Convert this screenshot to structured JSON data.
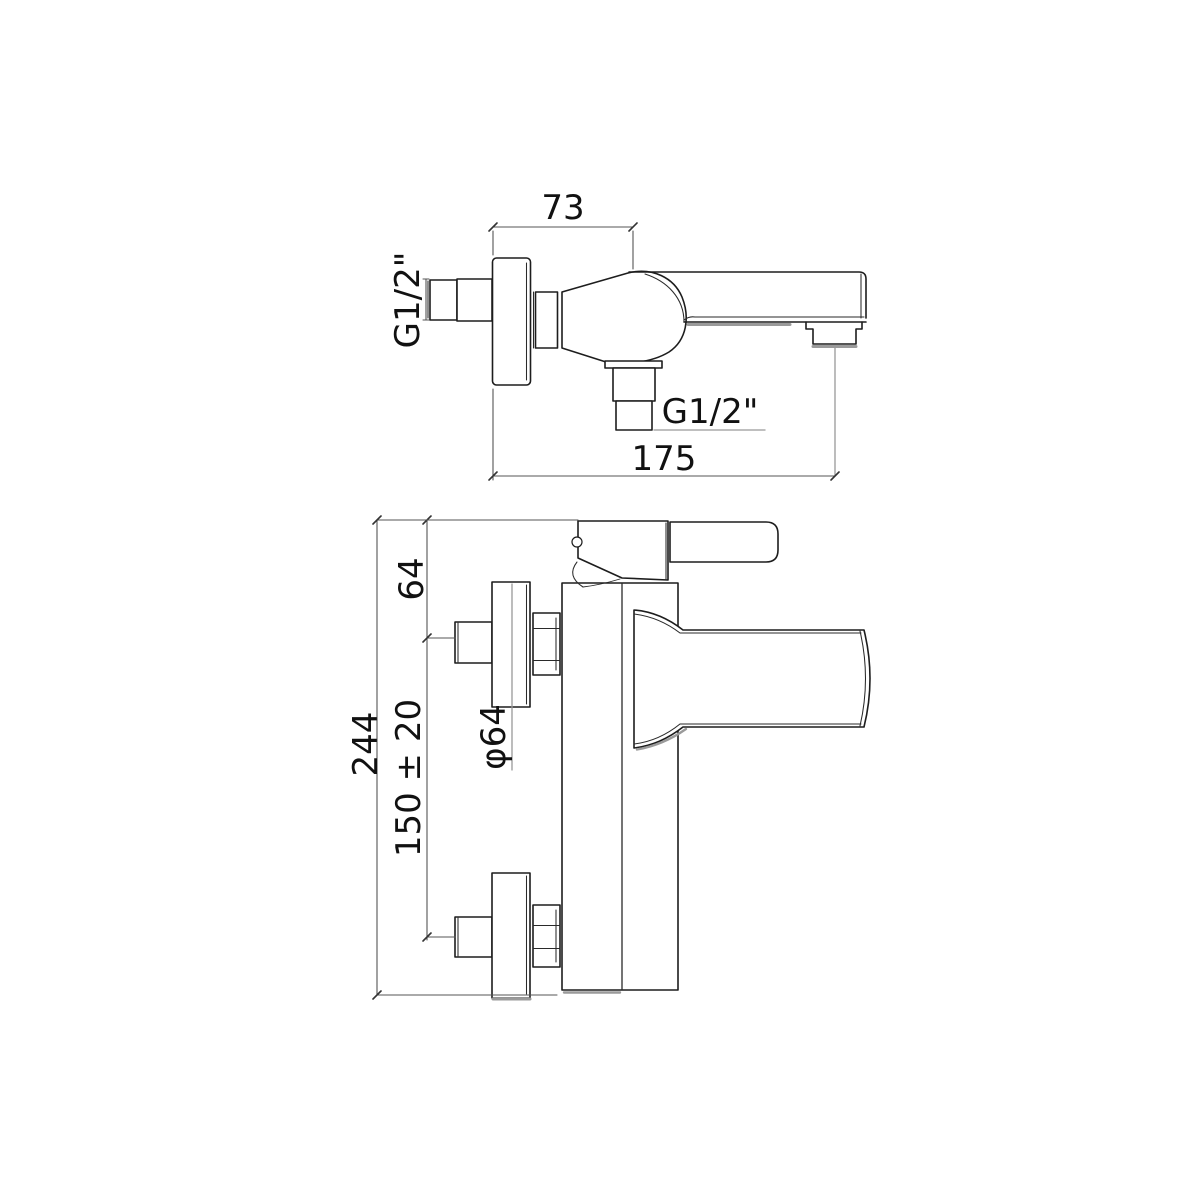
{
  "drawing": {
    "type": "technical-dimension-drawing",
    "subject": "wall-mounted bath shower mixer tap, side view and front view",
    "top_view": {
      "dim_wall_to_valve_center": "73",
      "inlet_thread_label": "G1/2\"",
      "outlet_thread_label": "G1/2\"",
      "dim_wall_to_spout_outlet": "175"
    },
    "front_view": {
      "dim_top_to_inlet_center": "64",
      "dim_total_height": "244",
      "dim_inlet_centers_spacing": "150 ± 20",
      "dim_flange_diameter": "φ64"
    },
    "colors": {
      "background": "#ffffff",
      "outline": "#1d1d1d",
      "dimension_line": "#555555",
      "leader_line": "#999999",
      "shadow_line": "#9a9a9a",
      "text": "#111111"
    }
  }
}
